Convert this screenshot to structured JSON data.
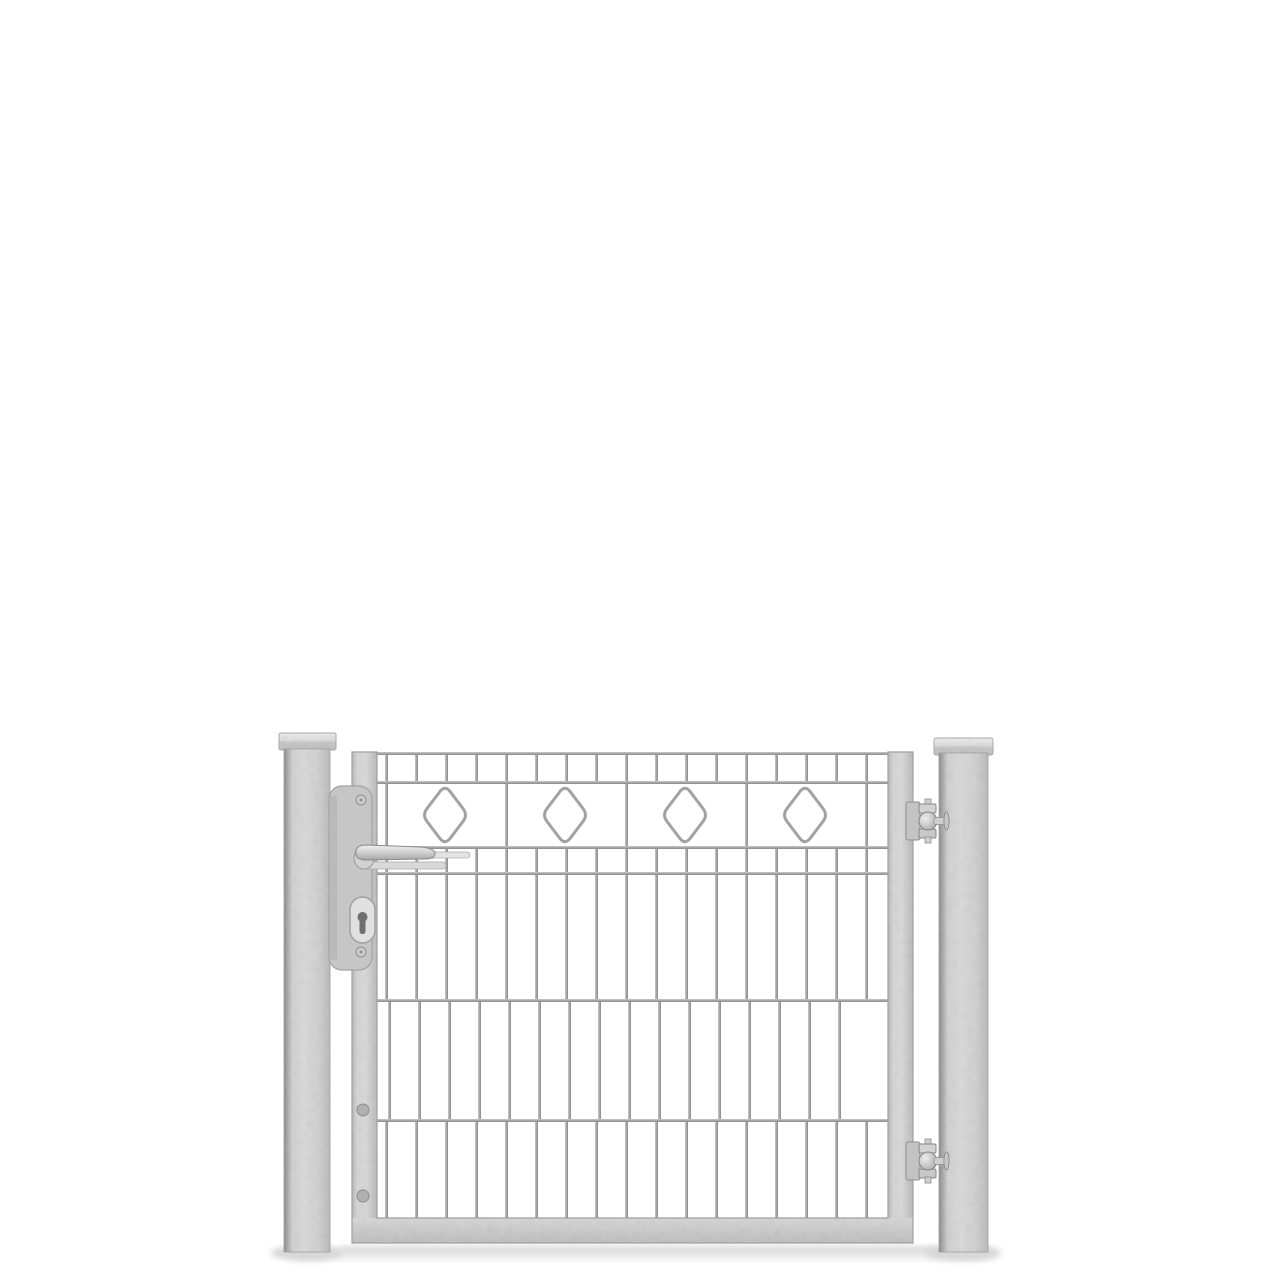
{
  "scene": {
    "background_color": "#ffffff",
    "ground_shadow_color": "#dedede"
  },
  "colors": {
    "steel_highlight": "#ededed",
    "steel_light": "#d8d8d8",
    "steel_mid": "#c9c9c9",
    "steel_edge": "#9f9f9f",
    "wire_light": "#c9c9c9",
    "wire_mid": "#a6a6a6",
    "wire_dark": "#8a8a8a",
    "keyhole_dark": "#6e6e6e"
  },
  "gate": {
    "posts": 2,
    "hinges": 2,
    "diamond_ornaments": 4,
    "mesh_columns": 17,
    "horizontal_rails": 6,
    "handle_side": "left",
    "hinge_side": "right"
  }
}
